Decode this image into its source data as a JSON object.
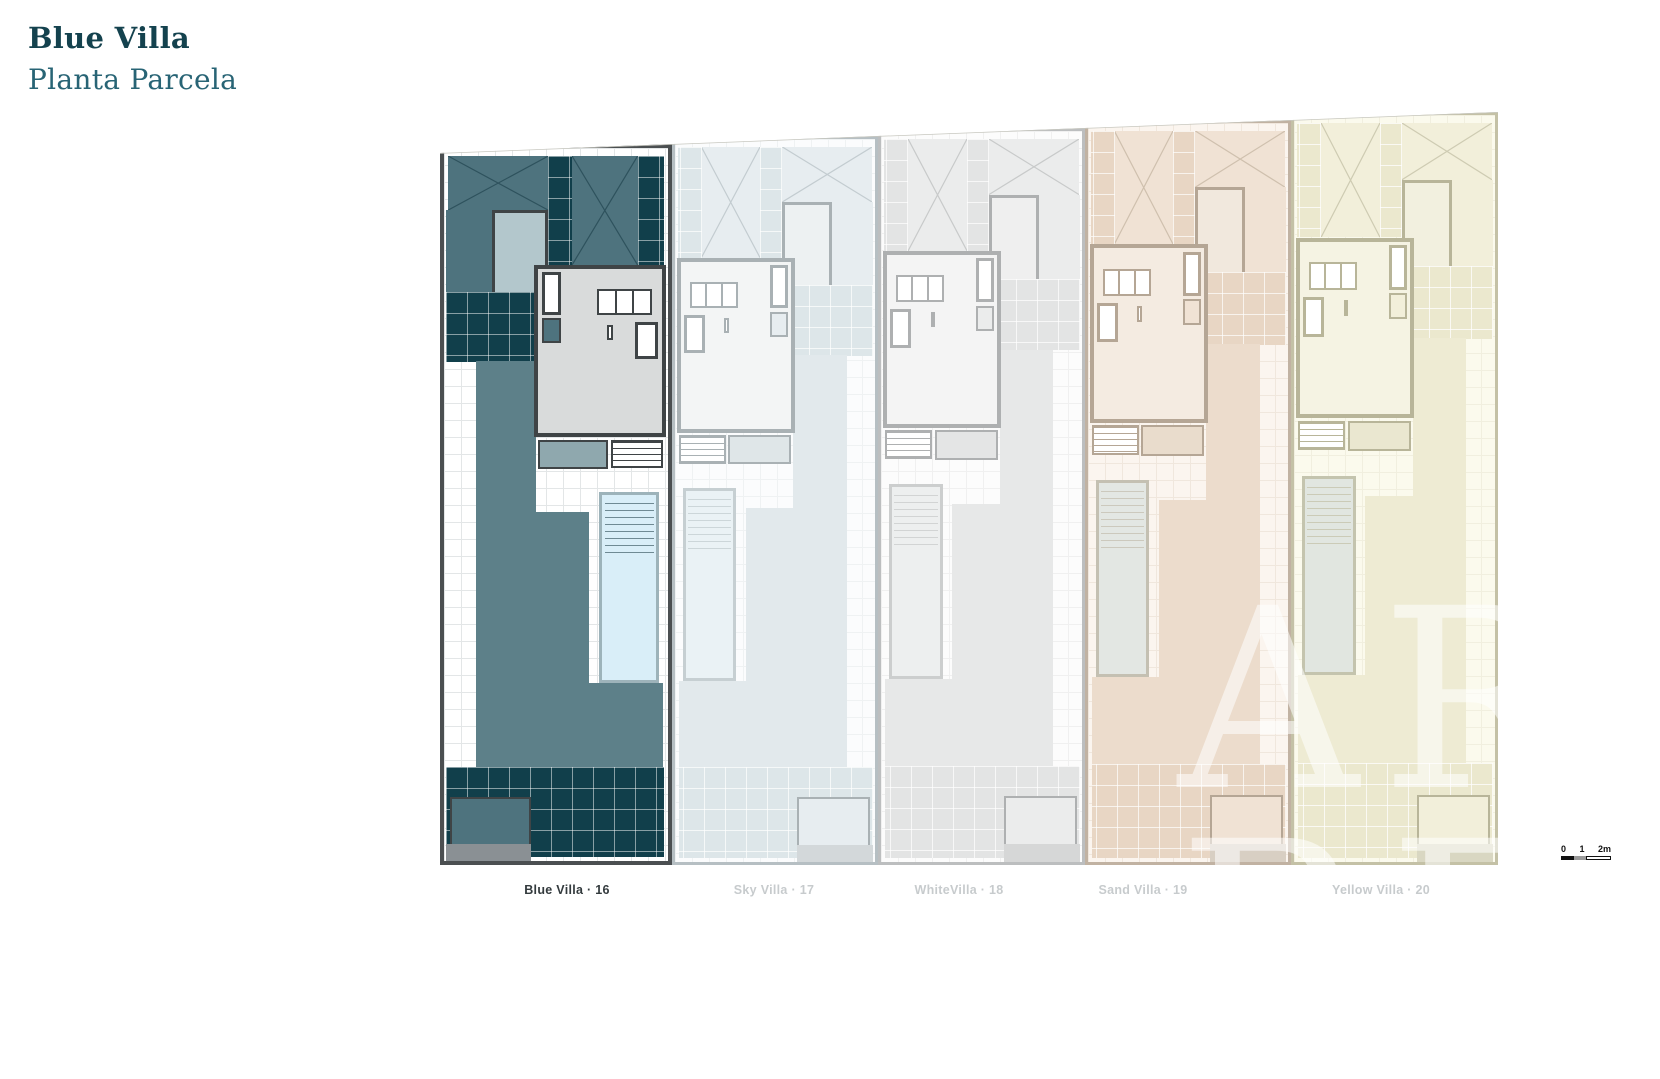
{
  "header": {
    "title": "Blue Villa",
    "subtitle": "Planta Parcela",
    "title_color": "#14424e",
    "subtitle_color": "#286475"
  },
  "site": {
    "villas": [
      {
        "id": "blue",
        "label": "Blue Villa · 16",
        "active": true,
        "mirrored": false,
        "palette": {
          "border": "#4b4f51",
          "tile": "#e3e6e7",
          "base": "#ffffff",
          "mid": "#4e737e",
          "mid2": "#5d8089",
          "dark": "#113f4b",
          "gline": "rgba(255,255,255,0.5)",
          "planter": "#b3c7cc",
          "bldg": "#d9dbdb",
          "bborder": "#3f4446",
          "deck": "#8fa8ae",
          "pool": "#d9eef8",
          "pborder": "#9db3ba",
          "pline": "#6f8a94",
          "gray": "#8a9094",
          "xline": "#2e525d"
        }
      },
      {
        "id": "sky",
        "label": "Sky Villa · 17",
        "active": false,
        "mirrored": true,
        "palette": {
          "border": "#b6bfc3",
          "tile": "#eff2f3",
          "base": "#fbfcfd",
          "mid": "#e7edf0",
          "mid2": "#e2e9ec",
          "dark": "#dde6e9",
          "gline": "rgba(255,255,255,0.7)",
          "planter": "#edf1f2",
          "bldg": "#f3f5f5",
          "bborder": "#a9b1b4",
          "deck": "#dfe6e8",
          "pool": "#eaf2f5",
          "pborder": "#c6cfd2",
          "pline": "#ccd6d9",
          "gray": "#d3d8da",
          "xline": "#c3ccd0"
        }
      },
      {
        "id": "white",
        "label": "WhiteVilla · 18",
        "active": false,
        "mirrored": true,
        "palette": {
          "border": "#bcbebf",
          "tile": "#f0f0f0",
          "base": "#fcfcfc",
          "mid": "#ebecec",
          "mid2": "#e7e8e8",
          "dark": "#e3e4e4",
          "gline": "rgba(255,255,255,0.7)",
          "planter": "#efefef",
          "bldg": "#f4f4f4",
          "bborder": "#aeb0b1",
          "deck": "#e4e5e5",
          "pool": "#edefef",
          "pborder": "#cccece",
          "pline": "#d2d4d4",
          "gray": "#d6d7d7",
          "xline": "#c8caca"
        }
      },
      {
        "id": "sand",
        "label": "Sand Villa · 19",
        "active": false,
        "mirrored": true,
        "palette": {
          "border": "#c1b2a2",
          "tile": "#f0e7dd",
          "base": "#fbf5ef",
          "mid": "#f0e2d4",
          "mid2": "#ecdccc",
          "dark": "#e8d6c4",
          "gline": "rgba(255,255,255,0.7)",
          "planter": "#f1e8dd",
          "bldg": "#f4ebe1",
          "bborder": "#b5a695",
          "deck": "#e9dccc",
          "pool": "#e3e7e3",
          "pborder": "#c4c0b2",
          "pline": "#ccc9bd",
          "gray": "#d8cfc3",
          "xline": "#cfc0ae"
        }
      },
      {
        "id": "yellow",
        "label": "Yellow Villa · 20",
        "active": false,
        "mirrored": true,
        "palette": {
          "border": "#c4c1a6",
          "tile": "#f1efdf",
          "base": "#fbfaed",
          "mid": "#f2efda",
          "mid2": "#eeebd3",
          "dark": "#ebe8ce",
          "gline": "rgba(255,255,255,0.75)",
          "planter": "#f2f0df",
          "bldg": "#f5f3e3",
          "bborder": "#b8b599",
          "deck": "#eae7d0",
          "pool": "#e1e6e0",
          "pborder": "#c4c4ae",
          "pline": "#cbcbb7",
          "gray": "#d9d7c2",
          "xline": "#cecbb2"
        }
      }
    ],
    "boundary_color": "#c8c8c0",
    "scale_bar": {
      "labels": [
        "0",
        "1",
        "2m"
      ]
    },
    "watermark": {
      "line1": "ARE",
      "line2": "REAL"
    },
    "label_active_color": "#333a3d",
    "label_inactive_color": "#c7cbcd"
  }
}
